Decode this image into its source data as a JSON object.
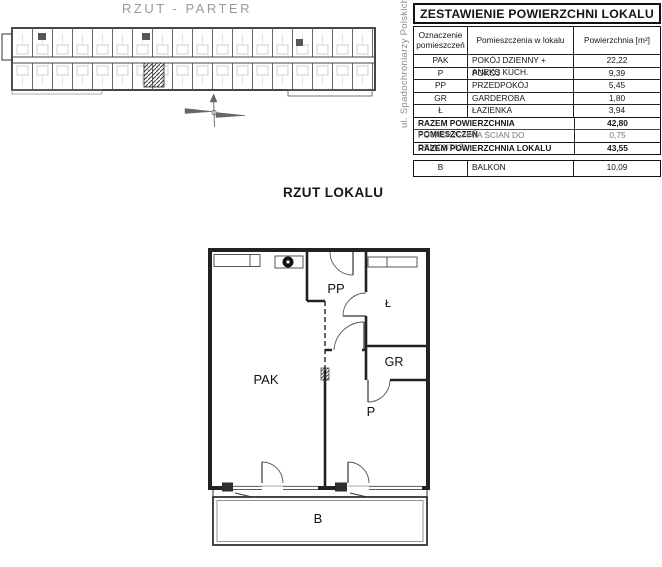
{
  "titles": {
    "site_plan": "RZUT - PARTER",
    "street": "ul. Spadochroniarzy Polskich",
    "apartment_plan": "RZUT LOKALU"
  },
  "area_table": {
    "title": "ZESTAWIENIE POWIERZCHNI LOKALU",
    "col_code": "Oznaczenie pomieszczeń",
    "col_name": "Pomieszczenia w lokalu",
    "col_area": "Powierzchnia [m²]",
    "rows": [
      {
        "code": "PAK",
        "name": "POKÓJ DZIENNY + ANEKS KUCH.",
        "area": "22,22"
      },
      {
        "code": "P",
        "name": "POKÓJ",
        "area": "9,39"
      },
      {
        "code": "PP",
        "name": "PRZEDPOKÓJ",
        "area": "5,45"
      },
      {
        "code": "GR",
        "name": "GARDEROBA",
        "area": "1,80"
      },
      {
        "code": "Ł",
        "name": "ŁAZIENKA",
        "area": "3,94"
      }
    ],
    "summary": [
      {
        "label": "RAZEM POWIERZCHNIA POMIESZCZEŃ",
        "area": "42,80"
      },
      {
        "label": "POWIERZCHNIA ŚCIAN DO DEMONTAŻU",
        "area": "0,75"
      },
      {
        "label": "RAZEM POWIERZCHNIA LOKALU",
        "area": "43,55"
      }
    ],
    "balcony": {
      "code": "B",
      "name": "BALKON",
      "area": "10,09"
    }
  },
  "plan_labels": {
    "pak": "PAK",
    "pp": "PP",
    "lazienka": "Ł",
    "gr": "GR",
    "p": "P",
    "b": "B"
  },
  "colors": {
    "ink": "#222222",
    "faint": "#9b9b9b"
  }
}
